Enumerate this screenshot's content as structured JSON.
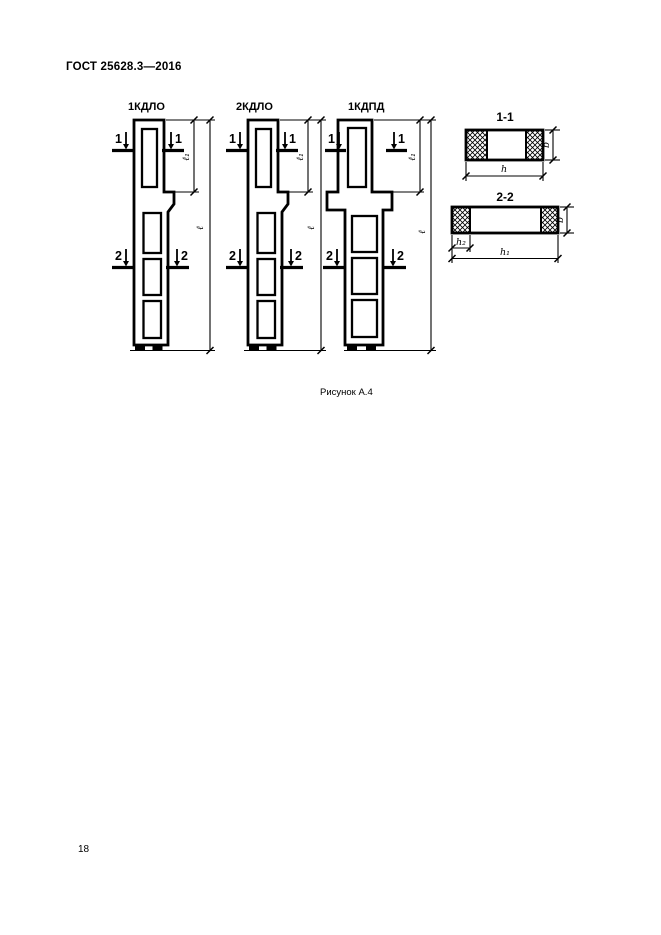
{
  "page": {
    "standard_number": "ГОСТ 25628.3—2016",
    "caption": "Рисунок А.4",
    "page_number": "18"
  },
  "figure": {
    "columns": [
      {
        "label": "1КДЛО"
      },
      {
        "label": "2КДЛО"
      },
      {
        "label": "1КДПД"
      }
    ],
    "sections": [
      {
        "title": "1-1"
      },
      {
        "title": "2-2"
      }
    ],
    "cut_marks": {
      "first": "1",
      "second": "2"
    },
    "dims": {
      "l": "ℓ",
      "l1": "ℓ₁",
      "b": "b",
      "h": "h",
      "h1": "h₁",
      "h2": "h₂"
    }
  }
}
